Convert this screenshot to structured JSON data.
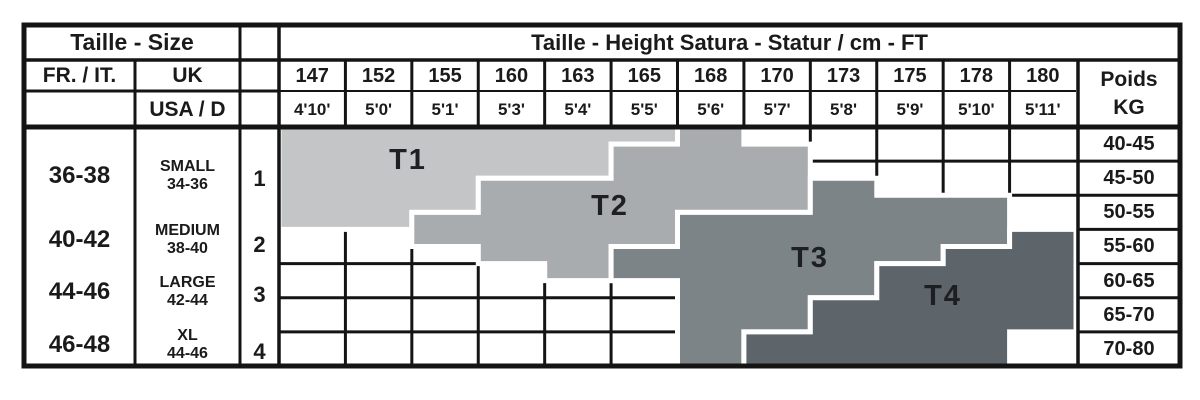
{
  "table": {
    "corner": {
      "taille_size": "Taille - Size",
      "fr_it": "FR. / IT.",
      "uk": "UK",
      "usa_d": "USA / D"
    },
    "title": "Taille - Height Satura - Statur / cm - FT",
    "poids": {
      "line1": "Poids",
      "line2": "KG"
    },
    "heights_cm": [
      "147",
      "152",
      "155",
      "160",
      "163",
      "165",
      "168",
      "170",
      "173",
      "175",
      "178",
      "180"
    ],
    "heights_ft": [
      "4'10'",
      "5'0'",
      "5'1'",
      "5'3'",
      "5'4'",
      "5'5'",
      "5'6'",
      "5'7'",
      "5'8'",
      "5'9'",
      "5'10'",
      "5'11'"
    ],
    "weights_kg": [
      "40-45",
      "45-50",
      "50-55",
      "55-60",
      "60-65",
      "65-70",
      "70-80"
    ],
    "size_rows": [
      {
        "fr_it": "36-38",
        "uk_label": "SMALL",
        "uk_range": "34-36",
        "index": "1"
      },
      {
        "fr_it": "40-42",
        "uk_label": "MEDIUM",
        "uk_range": "38-40",
        "index": "2"
      },
      {
        "fr_it": "44-46",
        "uk_label": "LARGE",
        "uk_range": "42-44",
        "index": "3"
      },
      {
        "fr_it": "46-48",
        "uk_label": "XL",
        "uk_range": "44-46",
        "index": "4"
      }
    ]
  },
  "chart_data": {
    "type": "heatmap",
    "title": "Taille - Height Satura - Statur / cm - FT",
    "x_categories_cm": [
      "147",
      "152",
      "155",
      "160",
      "163",
      "165",
      "168",
      "170",
      "173",
      "175",
      "178",
      "180"
    ],
    "x_categories_ft": [
      "4'10'",
      "5'0'",
      "5'1'",
      "5'3'",
      "5'4'",
      "5'5'",
      "5'6'",
      "5'7'",
      "5'8'",
      "5'9'",
      "5'10'",
      "5'11'"
    ],
    "y_categories_kg": [
      "40-45",
      "45-50",
      "50-55",
      "55-60",
      "60-65",
      "65-70",
      "70-80"
    ],
    "polygon_units": "[height_column_boundary 0-12, weight_row_boundary 0-7]",
    "sizes": [
      {
        "label": "T1",
        "row_index": "1",
        "fr_it": "36-38",
        "uk": "SMALL",
        "usa_d": "34-36",
        "color": "#c3c5c7",
        "polygon": [
          [
            0,
            0
          ],
          [
            6,
            0
          ],
          [
            6,
            0.5
          ],
          [
            5,
            0.5
          ],
          [
            5,
            1.5
          ],
          [
            3,
            1.5
          ],
          [
            3,
            2.5
          ],
          [
            2,
            2.5
          ],
          [
            2,
            3
          ],
          [
            0,
            3
          ]
        ]
      },
      {
        "label": "T2",
        "row_index": "2",
        "fr_it": "40-42",
        "uk": "MEDIUM",
        "usa_d": "38-40",
        "color": "#a9acae",
        "polygon": [
          [
            2,
            2.5
          ],
          [
            3,
            2.5
          ],
          [
            3,
            1.5
          ],
          [
            5,
            1.5
          ],
          [
            5,
            0.5
          ],
          [
            6,
            0.5
          ],
          [
            6,
            0
          ],
          [
            7,
            0
          ],
          [
            7,
            0.5
          ],
          [
            8,
            0.5
          ],
          [
            8,
            2.5
          ],
          [
            6,
            2.5
          ],
          [
            6,
            3.5
          ],
          [
            5,
            3.5
          ],
          [
            5,
            4.5
          ],
          [
            4,
            4.5
          ],
          [
            4,
            4
          ],
          [
            3,
            4
          ],
          [
            3,
            3.5
          ],
          [
            2,
            3.5
          ]
        ]
      },
      {
        "label": "T3",
        "row_index": "3",
        "fr_it": "44-46",
        "uk": "LARGE",
        "usa_d": "42-44",
        "color": "#7d8487",
        "polygon": [
          [
            5,
            3.5
          ],
          [
            6,
            3.5
          ],
          [
            6,
            2.5
          ],
          [
            8,
            2.5
          ],
          [
            8,
            1.5
          ],
          [
            9,
            1.5
          ],
          [
            9,
            2
          ],
          [
            11,
            2
          ],
          [
            11,
            3.5
          ],
          [
            10,
            3.5
          ],
          [
            10,
            4
          ],
          [
            9,
            4
          ],
          [
            9,
            5
          ],
          [
            8,
            5
          ],
          [
            8,
            6
          ],
          [
            7,
            6
          ],
          [
            7,
            7
          ],
          [
            6,
            7
          ],
          [
            6,
            4.5
          ],
          [
            5,
            4.5
          ]
        ]
      },
      {
        "label": "T4",
        "row_index": "4",
        "fr_it": "46-48",
        "uk": "XL",
        "usa_d": "44-46",
        "color": "#5d656b",
        "polygon": [
          [
            7,
            6
          ],
          [
            8,
            6
          ],
          [
            8,
            5
          ],
          [
            9,
            5
          ],
          [
            9,
            4
          ],
          [
            10,
            4
          ],
          [
            10,
            3.5
          ],
          [
            11,
            3.5
          ],
          [
            11,
            3
          ],
          [
            12,
            3
          ],
          [
            12,
            6
          ],
          [
            11,
            6
          ],
          [
            11,
            7
          ],
          [
            7,
            7
          ]
        ]
      }
    ]
  },
  "colors": {
    "grid": "#141414",
    "text": "#1a1a1a",
    "band_outline": "#ffffff"
  }
}
